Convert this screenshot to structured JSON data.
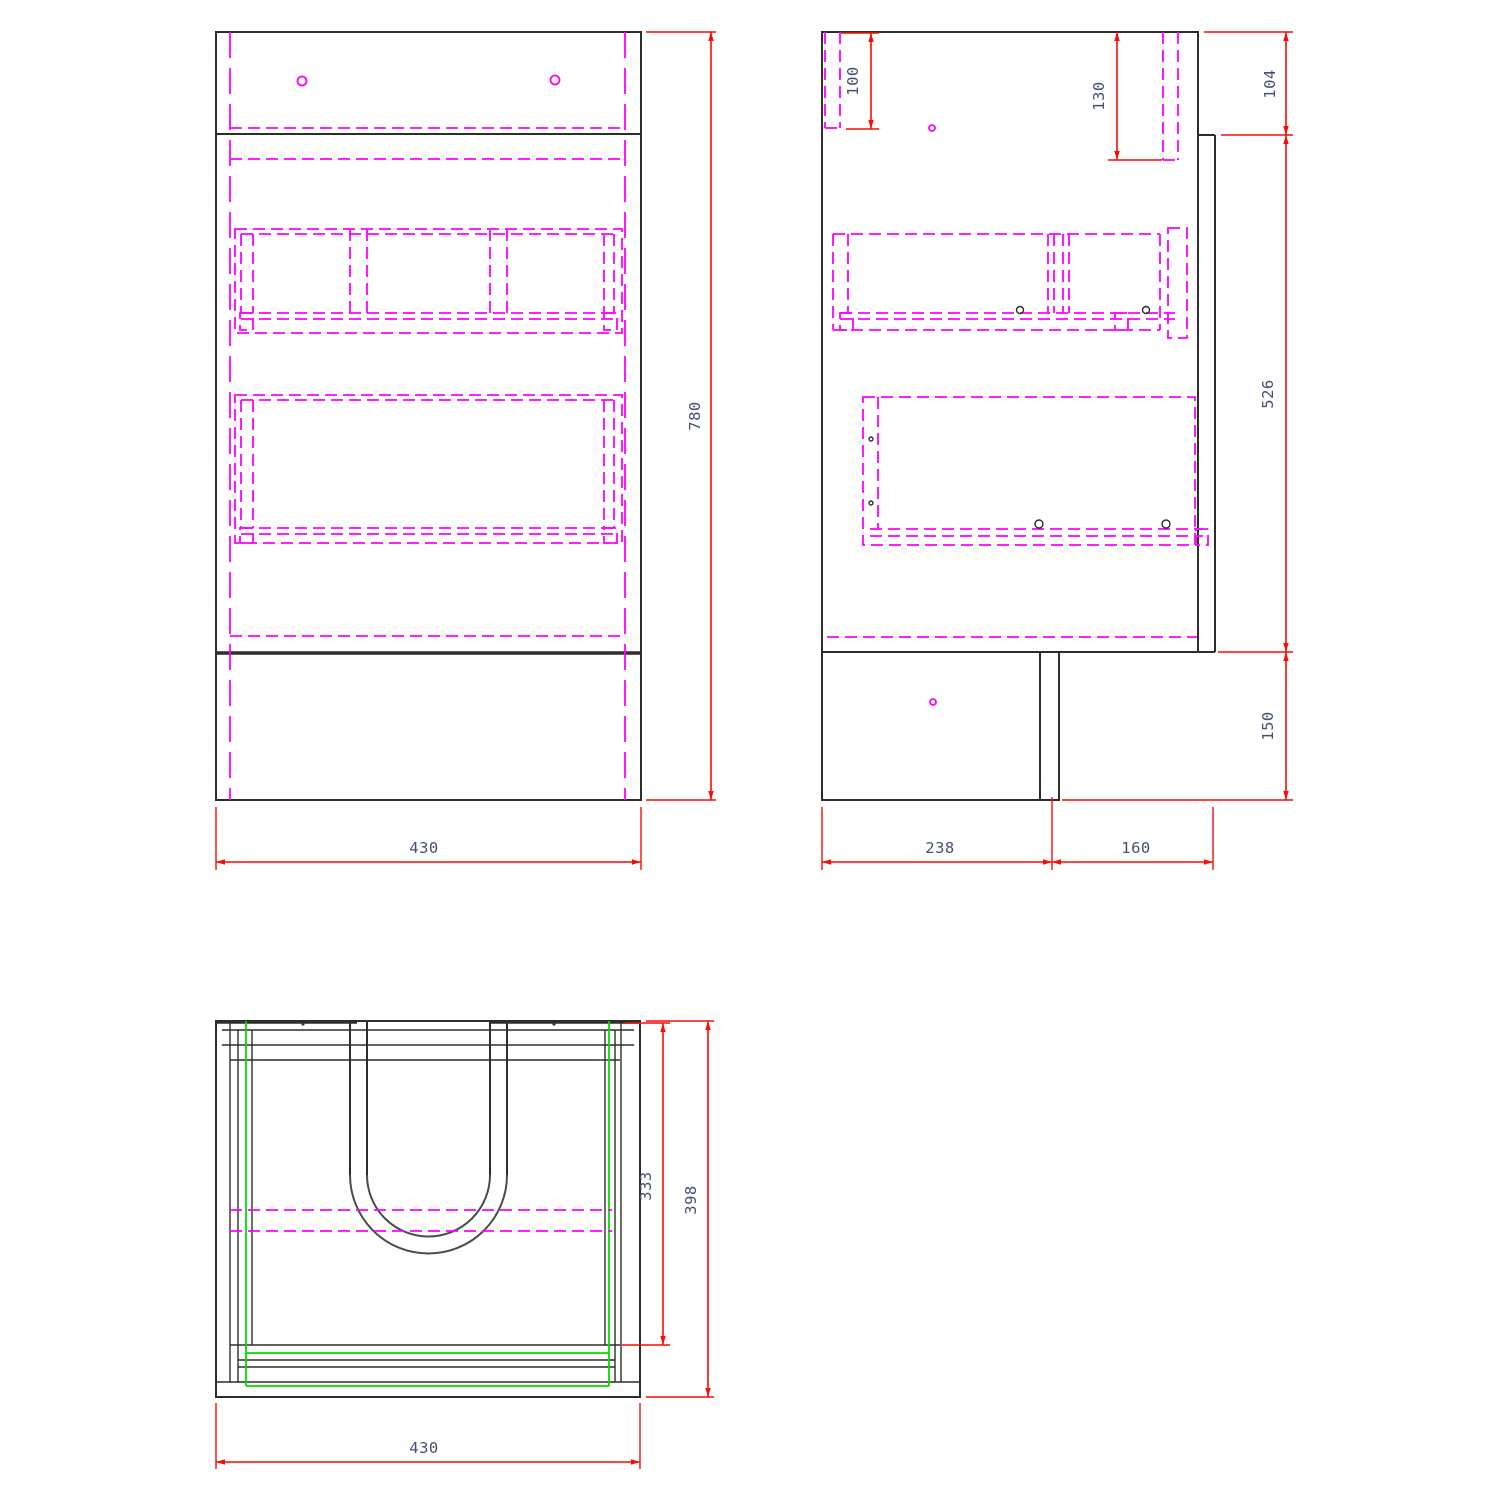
{
  "drawing": {
    "type": "cad-technical-drawing",
    "subject": "bathroom-vanity-unit-three-views",
    "colors": {
      "outline": "#2d2d2d",
      "hidden_detail": "#ff00ff",
      "highlight_green": "#00dc00",
      "dimension_red": "#fa0b05",
      "dimension_text": "#44507a",
      "cutout_arc": "#4c4c4c",
      "background": "#ffffff"
    },
    "views": {
      "front": {
        "label": "front-view",
        "dims": {
          "width": "430",
          "height": "780"
        }
      },
      "side": {
        "label": "side-view",
        "dims": {
          "hang_rail_drop": "100",
          "rail_length": "130",
          "top_back_step": "104",
          "body_height": "526",
          "plinth_height": "150",
          "plinth_depth": "238",
          "rear_recess": "160"
        }
      },
      "plan": {
        "label": "plan-view",
        "dims": {
          "cutout_depth": "333",
          "overall_depth": "398",
          "width": "430"
        }
      }
    }
  }
}
